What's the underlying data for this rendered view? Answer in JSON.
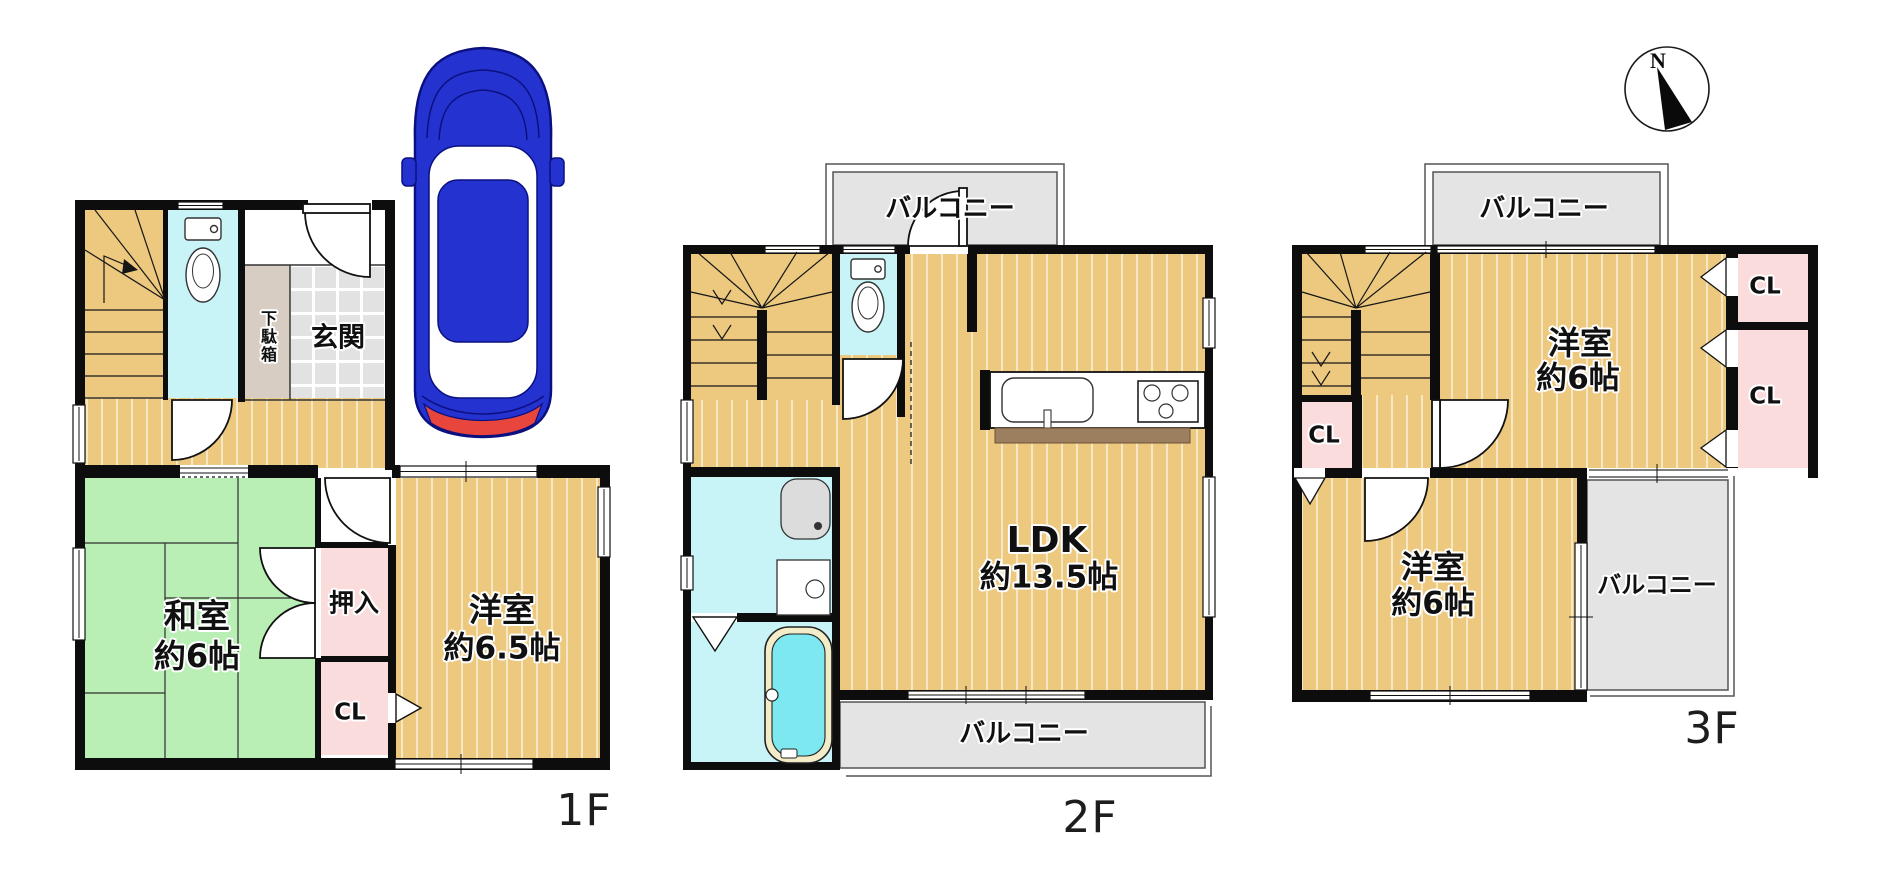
{
  "canvas": {
    "width": 1893,
    "height": 872,
    "background": "#ffffff"
  },
  "compass": {
    "north_label": "N"
  },
  "floor1": {
    "floor_label": "1F",
    "entrance": "玄関",
    "shoe_box": "下駄箱",
    "japanese_room_name": "和室",
    "japanese_room_size": "約6帖",
    "oshiire_closet": "押入",
    "closet": "CL",
    "western_room_name": "洋室",
    "western_room_size": "約6.5帖"
  },
  "floor2": {
    "floor_label": "2F",
    "balcony_top": "バルコニー",
    "ldk_name": "LDK",
    "ldk_size": "約13.5帖",
    "balcony_bottom": "バルコニー"
  },
  "floor3": {
    "floor_label": "3F",
    "balcony_top": "バルコニー",
    "western_room_upper_name": "洋室",
    "western_room_upper_size": "約6帖",
    "closet_right_top": "CL",
    "closet_right_bottom": "CL",
    "closet_left": "CL",
    "western_room_lower_name": "洋室",
    "western_room_lower_size": "約6帖",
    "balcony_right": "バルコニー"
  },
  "colors": {
    "wall": "#0d0d0d",
    "wood_floor": "#ecc97e",
    "tatami_green": "#b9eeb4",
    "closet_pink": "#fbdcdc",
    "water_cyan": "#c9f4f7",
    "bathtub_cyan": "#7de8ef",
    "tile_gray": "#e2e2e2",
    "balcony_gray": "#e4e4e4",
    "shoe_box_beige": "#d7cdc2",
    "counter_brown": "#9c7f5e",
    "car_blue": "#2433d0",
    "tail_light_red": "#e8453c"
  }
}
